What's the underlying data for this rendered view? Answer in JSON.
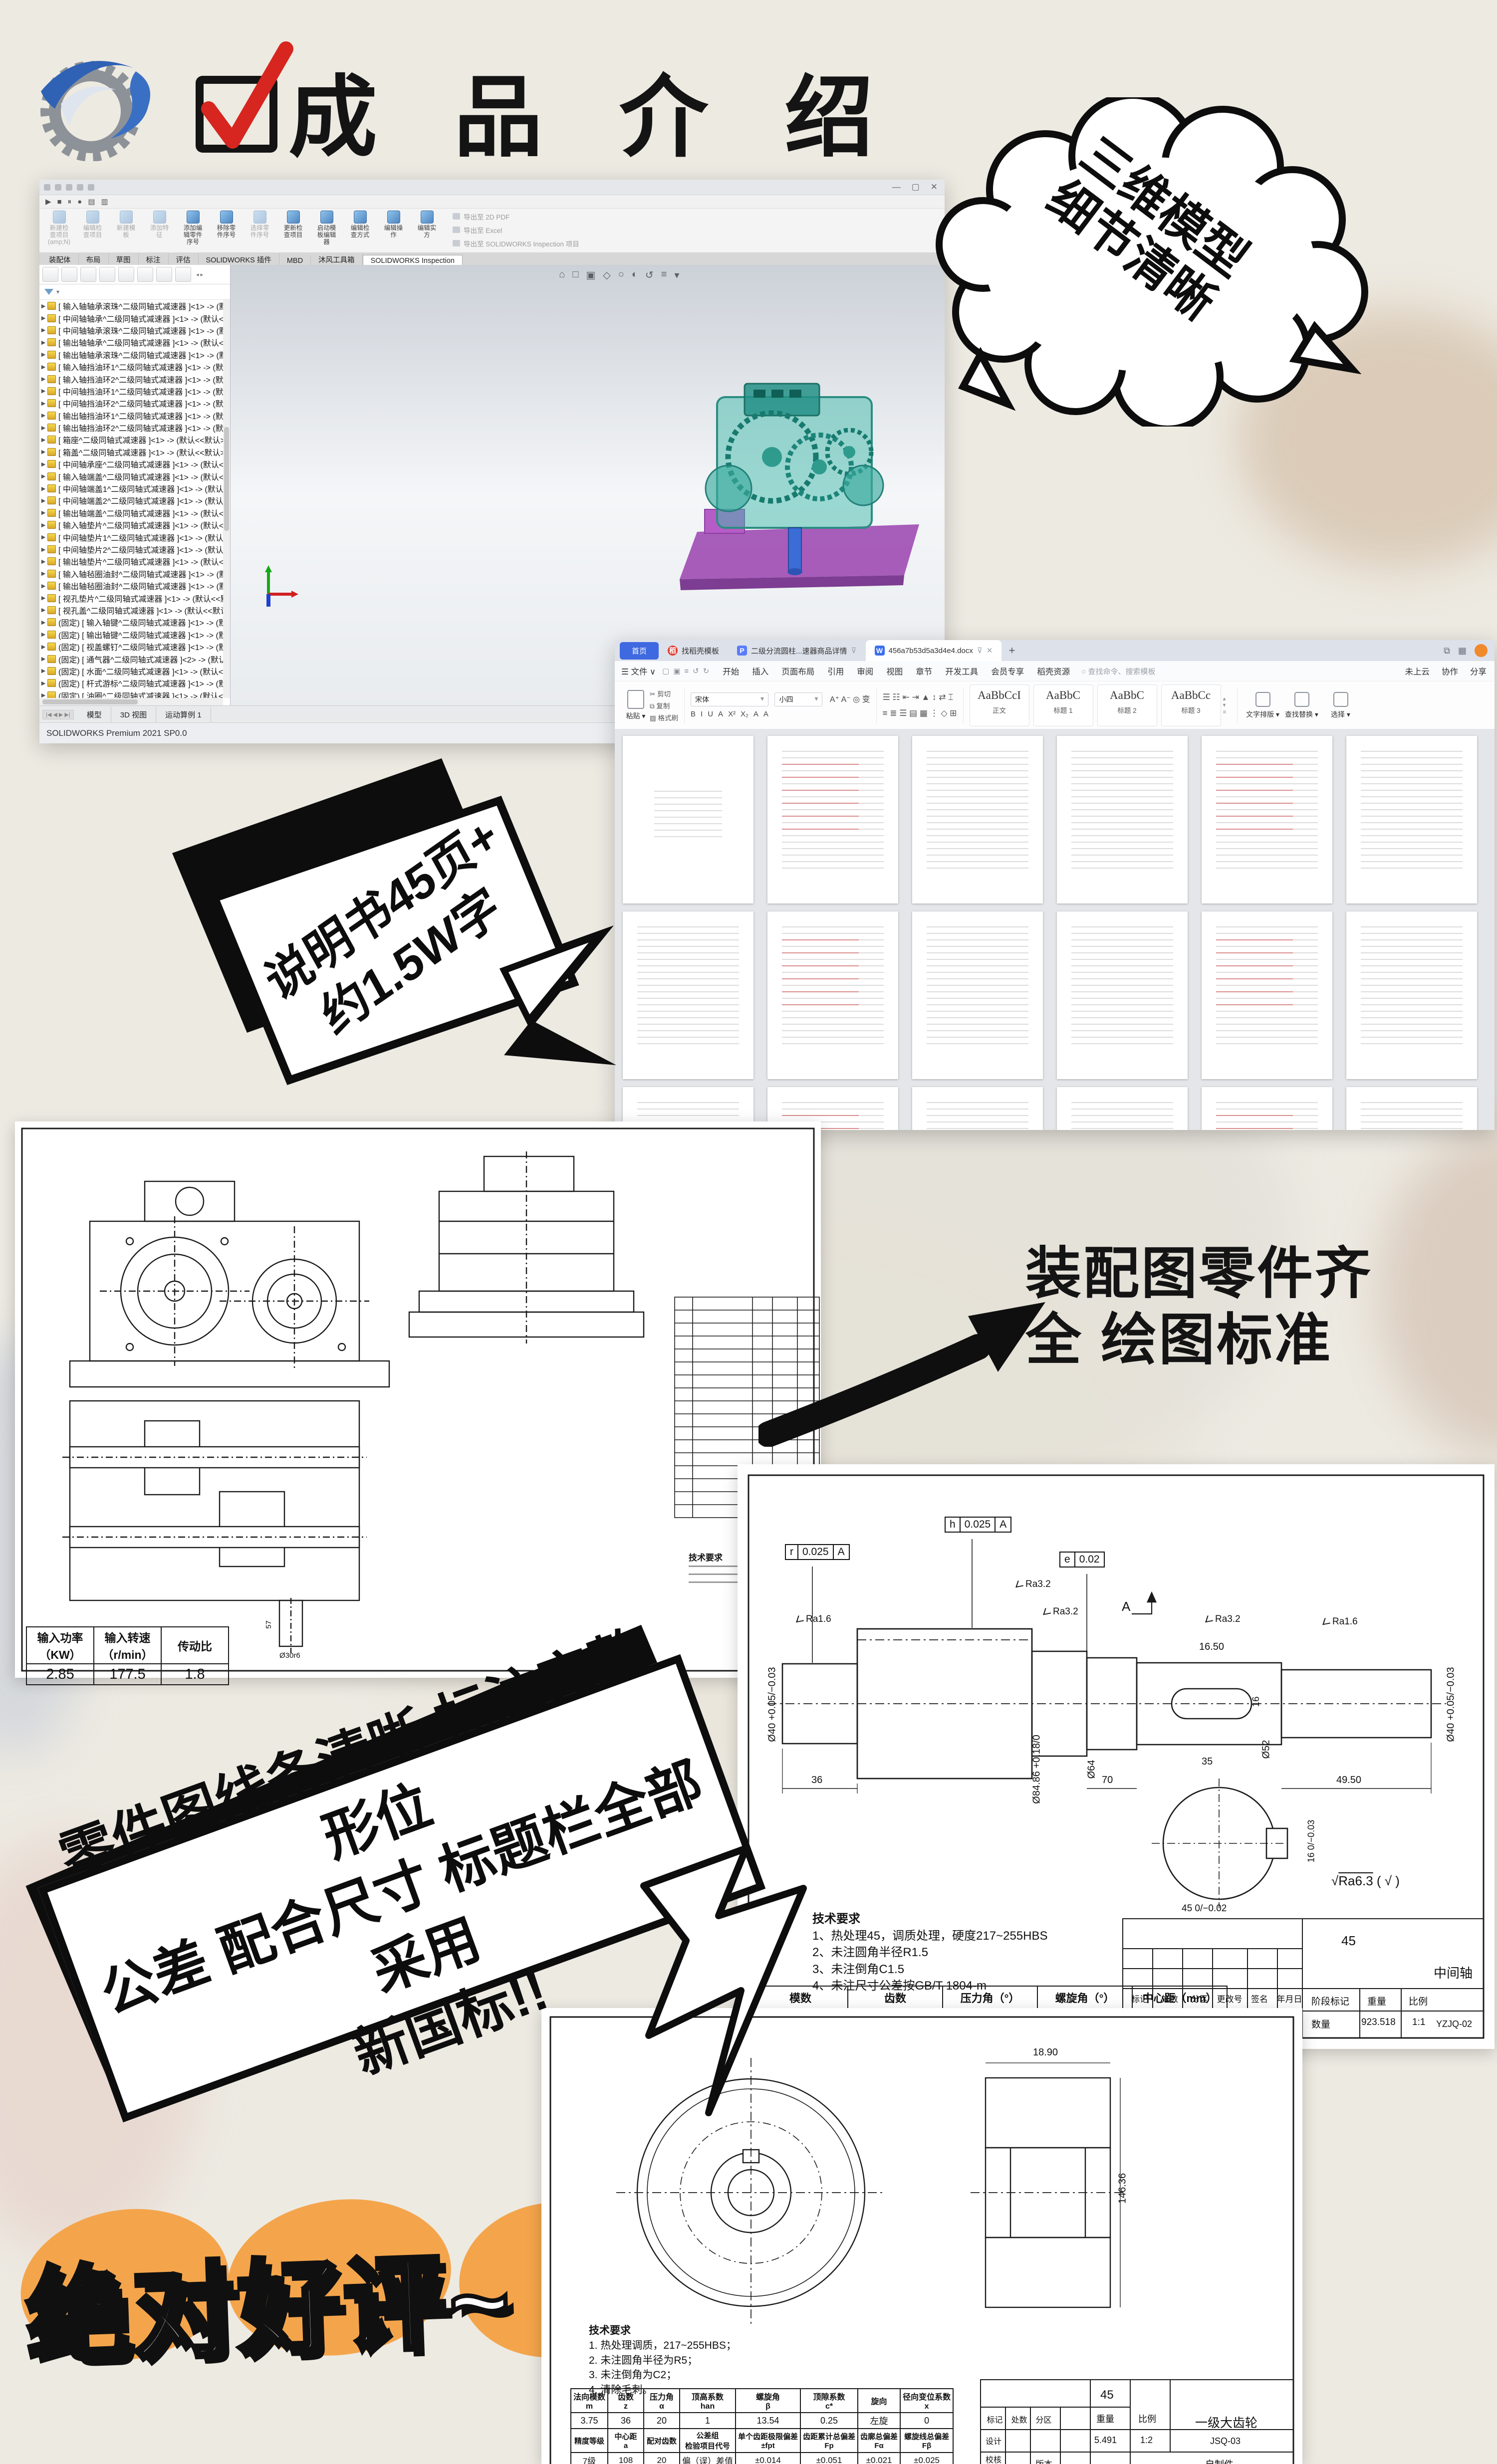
{
  "header": {
    "title": "成 品 介 绍"
  },
  "cloud": {
    "line1": "三维模型",
    "line2": "细节清晰"
  },
  "manual_bubble": {
    "line1": "说明书45页+",
    "line2": "约1.5W字"
  },
  "assembly_note": {
    "line1": "装配图零件齐",
    "line2": "全 绘图标准"
  },
  "banner": {
    "line1": "零件图线条清晰 标注完整 形位",
    "line2": "公差 配合尺寸 标题栏全部采用",
    "line3": "新国标!!"
  },
  "footer": {
    "text": "绝对好评~"
  },
  "colors": {
    "accent_blue": "#3f69e0",
    "orange": "#f4a54b",
    "check_red": "#d6261f"
  },
  "solidworks": {
    "quickbar_icons": [
      "▶",
      "■",
      "⏸",
      "●",
      "▤",
      "▥"
    ],
    "ribbon_buttons": [
      "新建检\n查项目\n(amp;N)",
      "编辑检\n查项目",
      "新建模\n板",
      "添加特\n征",
      "添加编\n辑零件\n序号",
      "移除零\n件序号",
      "选择零\n件序号",
      "更新检\n查项目",
      "启动模\n板编辑\n器",
      "编辑检\n查方式",
      "编辑操\n作",
      "编辑实\n方"
    ],
    "export_items": [
      "导出至 2D PDF",
      "导出至 Excel",
      "导出至 SOLIDWORKS Inspection 项目"
    ],
    "tabs": [
      "装配体",
      "布局",
      "草图",
      "标注",
      "评估",
      "SOLIDWORKS 插件",
      "MBD",
      "沐风工具箱",
      "SOLIDWORKS Inspection"
    ],
    "viewport_icons": [
      "⌂",
      "□",
      "▣",
      "◇",
      "○",
      "◐",
      "↺",
      "≡",
      "▾"
    ],
    "tree_items": [
      "[ 输入轴轴承滚珠^二级同轴式减速器 ]<1> -> (默认<",
      "[ 中间轴轴承^二级同轴式减速器 ]<1> -> (默认<<默",
      "[ 中间轴轴承滚珠^二级同轴式减速器 ]<1> -> (默认<",
      "[ 输出轴轴承^二级同轴式减速器 ]<1> -> (默认<<默",
      "[ 输出轴轴承滚珠^二级同轴式减速器 ]<1> -> (默认<",
      "[ 输入轴挡油环1^二级同轴式减速器 ]<1> -> (默认<<",
      "[ 输入轴挡油环2^二级同轴式减速器 ]<1> -> (默认<<",
      "[ 中间轴挡油环1^二级同轴式减速器 ]<1> -> (默认<<",
      "[ 中间轴挡油环2^二级同轴式减速器 ]<1> -> (默认<<",
      "[ 输出轴挡油环1^二级同轴式减速器 ]<1> -> (默认<<",
      "[ 输出轴挡油环2^二级同轴式减速器 ]<1> -> (默认<<",
      "[ 箱座^二级同轴式减速器 ]<1> -> (默认<<默认>_显",
      "[ 箱盖^二级同轴式减速器 ]<1> -> (默认<<默认>_显",
      "[ 中间轴承座^二级同轴式减速器 ]<1> -> (默认<<默",
      "[ 输入轴端盖^二级同轴式减速器 ]<1> -> (默认<<默",
      "[ 中间轴端盖1^二级同轴式减速器 ]<1> -> (默认<<默",
      "[ 中间轴端盖2^二级同轴式减速器 ]<1> -> (默认<<默",
      "[ 输出轴端盖^二级同轴式减速器 ]<1> -> (默认<<默",
      "[ 输入轴垫片^二级同轴式减速器 ]<1> -> (默认<<默",
      "[ 中间轴垫片1^二级同轴式减速器 ]<1> -> (默认<<默",
      "[ 中间轴垫片2^二级同轴式减速器 ]<1> -> (默认<<默",
      "[ 输出轴垫片^二级同轴式减速器 ]<1> -> (默认<<默",
      "[ 输入轴毡圈油封^二级同轴式减速器 ]<1> -> (默认<",
      "[ 输出轴毡圈油封^二级同轴式减速器 ]<1> -> (默认<",
      "[ 视孔垫片^二级同轴式减速器 ]<1> -> (默认<<默认",
      "[ 视孔盖^二级同轴式减速器 ]<1> -> (默认<<默认>_",
      "(固定) [ 输入轴键^二级同轴式减速器 ]<1> -> (默认<",
      "(固定) [ 输出轴键^二级同轴式减速器 ]<1> -> (默认<",
      "(固定) [ 视盖螺钉^二级同轴式减速器 ]<1> -> (默认<",
      "(固定) [ 通气器^二级同轴式减速器 ]<2> -> (默认<<",
      "(固定) [ 水面^二级同轴式减速器 ]<1> -> (默认<<默",
      "(固定) [ 杆式游标^二级同轴式减速器 ]<1> -> (默认<",
      "(固定) [ 油圈^二级同轴式减速器 ]<1> -> (默认<<默"
    ],
    "bottom_tabs": [
      "模型",
      "3D 视图",
      "运动算例 1"
    ],
    "status": "SOLIDWORKS Premium 2021 SP0.0"
  },
  "wps": {
    "tab_home": "首页",
    "tab_template": "找稻壳模板",
    "tab_ppt": "二级分流圆柱...速器商品详情",
    "tab_doc": "456a7b53d5a3d4e4.docx",
    "file_menu": "文件",
    "menus": [
      "开始",
      "插入",
      "页面布局",
      "引用",
      "审阅",
      "视图",
      "章节",
      "开发工具",
      "会员专享",
      "稻壳资源"
    ],
    "search_placeholder": "查找命令、搜索模板",
    "account": [
      "未上云",
      "协作",
      "分享"
    ],
    "clipboard": {
      "paste": "粘贴",
      "cut": "剪切",
      "copy": "复制",
      "painter": "格式刷"
    },
    "font_name": "宋体",
    "font_size": "小四",
    "format_glyphs": [
      "B",
      "I",
      "U",
      "A",
      "X²",
      "X₂",
      "A",
      "A"
    ],
    "styles": [
      {
        "sample": "AaBbCcI",
        "label": "正文"
      },
      {
        "sample": "AaBbC",
        "label": "标题 1"
      },
      {
        "sample": "AaBbC",
        "label": "标题 2"
      },
      {
        "sample": "AaBbCc",
        "label": "标题 3"
      }
    ],
    "tools": [
      "文字排版",
      "查找替换",
      "选择"
    ]
  },
  "assembly_drawing": {
    "power_table": {
      "headers": [
        "输入功率（KW）",
        "输入转速（r/min）",
        "传动比"
      ],
      "values": [
        "2.85",
        "177.5",
        "1.8"
      ]
    },
    "tech_title": "技术要求",
    "stub_dim1": "57",
    "stub_dim2": "Ø30r6"
  },
  "shaft_drawing": {
    "datum_r": [
      "r",
      "0.025",
      "A"
    ],
    "datum_h": [
      "h",
      "0.025",
      "A"
    ],
    "datum_e": [
      "e",
      "0.02"
    ],
    "ra1": "Ra1.6",
    "ra2": "Ra3.2",
    "ra3": "Ra3.2",
    "ra4": "Ra3.2",
    "ra5": "Ra1.6",
    "section_label": "A",
    "dims": {
      "d_left": "Ø40 +0.05/−0.03",
      "d_gear": "Ø84.86 +0.18/0",
      "d_64": "Ø64",
      "d_52": "Ø52",
      "d_right": "Ø40 +0.05/−0.03",
      "key_len": "16.50",
      "key_w": "16",
      "key_l2": "35",
      "len1": "36",
      "len2": "70",
      "len3": "49.50",
      "sec_d": "45 0/−0.02",
      "sec_k": "16 0/−0.03"
    },
    "surface_ra": "Ra6.3",
    "surface_rest": "( √ )",
    "tech_title": "技术要求",
    "tech": [
      "1、热处理45，调质处理，硬度217~255HBS",
      "2、未注圆角半径R1.5",
      "3、未注倒角C1.5",
      "4、未注尺寸公差按GB/T 1804-m"
    ],
    "gear_table": {
      "headers": [
        "模数",
        "齿数",
        "压力角（°）",
        "螺旋角（°）",
        "中心距（mm）"
      ],
      "values": [
        "4.5",
        "25",
        "20",
        "13",
        "113"
      ]
    },
    "title_block": {
      "material": "45",
      "stage": "阶段标记",
      "weight_label": "重量",
      "scale_label": "比例",
      "qty": "数量",
      "weight": "923.518",
      "scale": "1:1",
      "name": "中间轴",
      "code": "YZJQ-02",
      "row1": [
        "标记",
        "处数",
        "分区",
        "更改号",
        "签名",
        "年月日"
      ],
      "col": [
        "设计",
        "校核",
        "主审"
      ]
    }
  },
  "gear_drawing": {
    "tech_title": "技术要求",
    "tech": [
      "1. 热处理调质，217~255HBS；",
      "2. 未注圆角半径为R5；",
      "3. 未注倒角为C2；",
      "4. 清除毛刺。"
    ],
    "param_table": {
      "r1": [
        "法向模数\nm",
        "齿数\nz",
        "压力角\nα",
        "顶高系数\nhan",
        "螺旋角\nβ",
        "顶隙系数\nc*",
        "旋向",
        "径向变位系数\nx"
      ],
      "r2": [
        "3.75",
        "36",
        "20",
        "1",
        "13.54",
        "0.25",
        "左旋",
        "0"
      ],
      "r3": [
        "精度等级",
        "中心距\na",
        "配对齿数",
        "公差组\n检验项目代号",
        "单个齿距极限偏差\n±fpt",
        "齿距累计总偏差\nFp",
        "齿廓总偏差\nFα",
        "螺旋线总偏差\nFβ"
      ],
      "r4": [
        "7级",
        "108",
        "20",
        "偏（误）差值",
        "±0.014",
        "±0.051",
        "±0.021",
        "±0.025"
      ]
    },
    "dims": {
      "v1": "146.36",
      "v2": "18.90"
    },
    "title_block": {
      "material": "45",
      "weight_label": "重量",
      "scale_label": "比例",
      "weight": "5.491",
      "scale": "1:2",
      "name": "一级大齿轮",
      "code": "JSQ-03",
      "type": "自制件",
      "version": "版本",
      "row1": [
        "标记",
        "处数",
        "分区"
      ],
      "col": [
        "设计",
        "校核",
        "主审"
      ]
    }
  }
}
